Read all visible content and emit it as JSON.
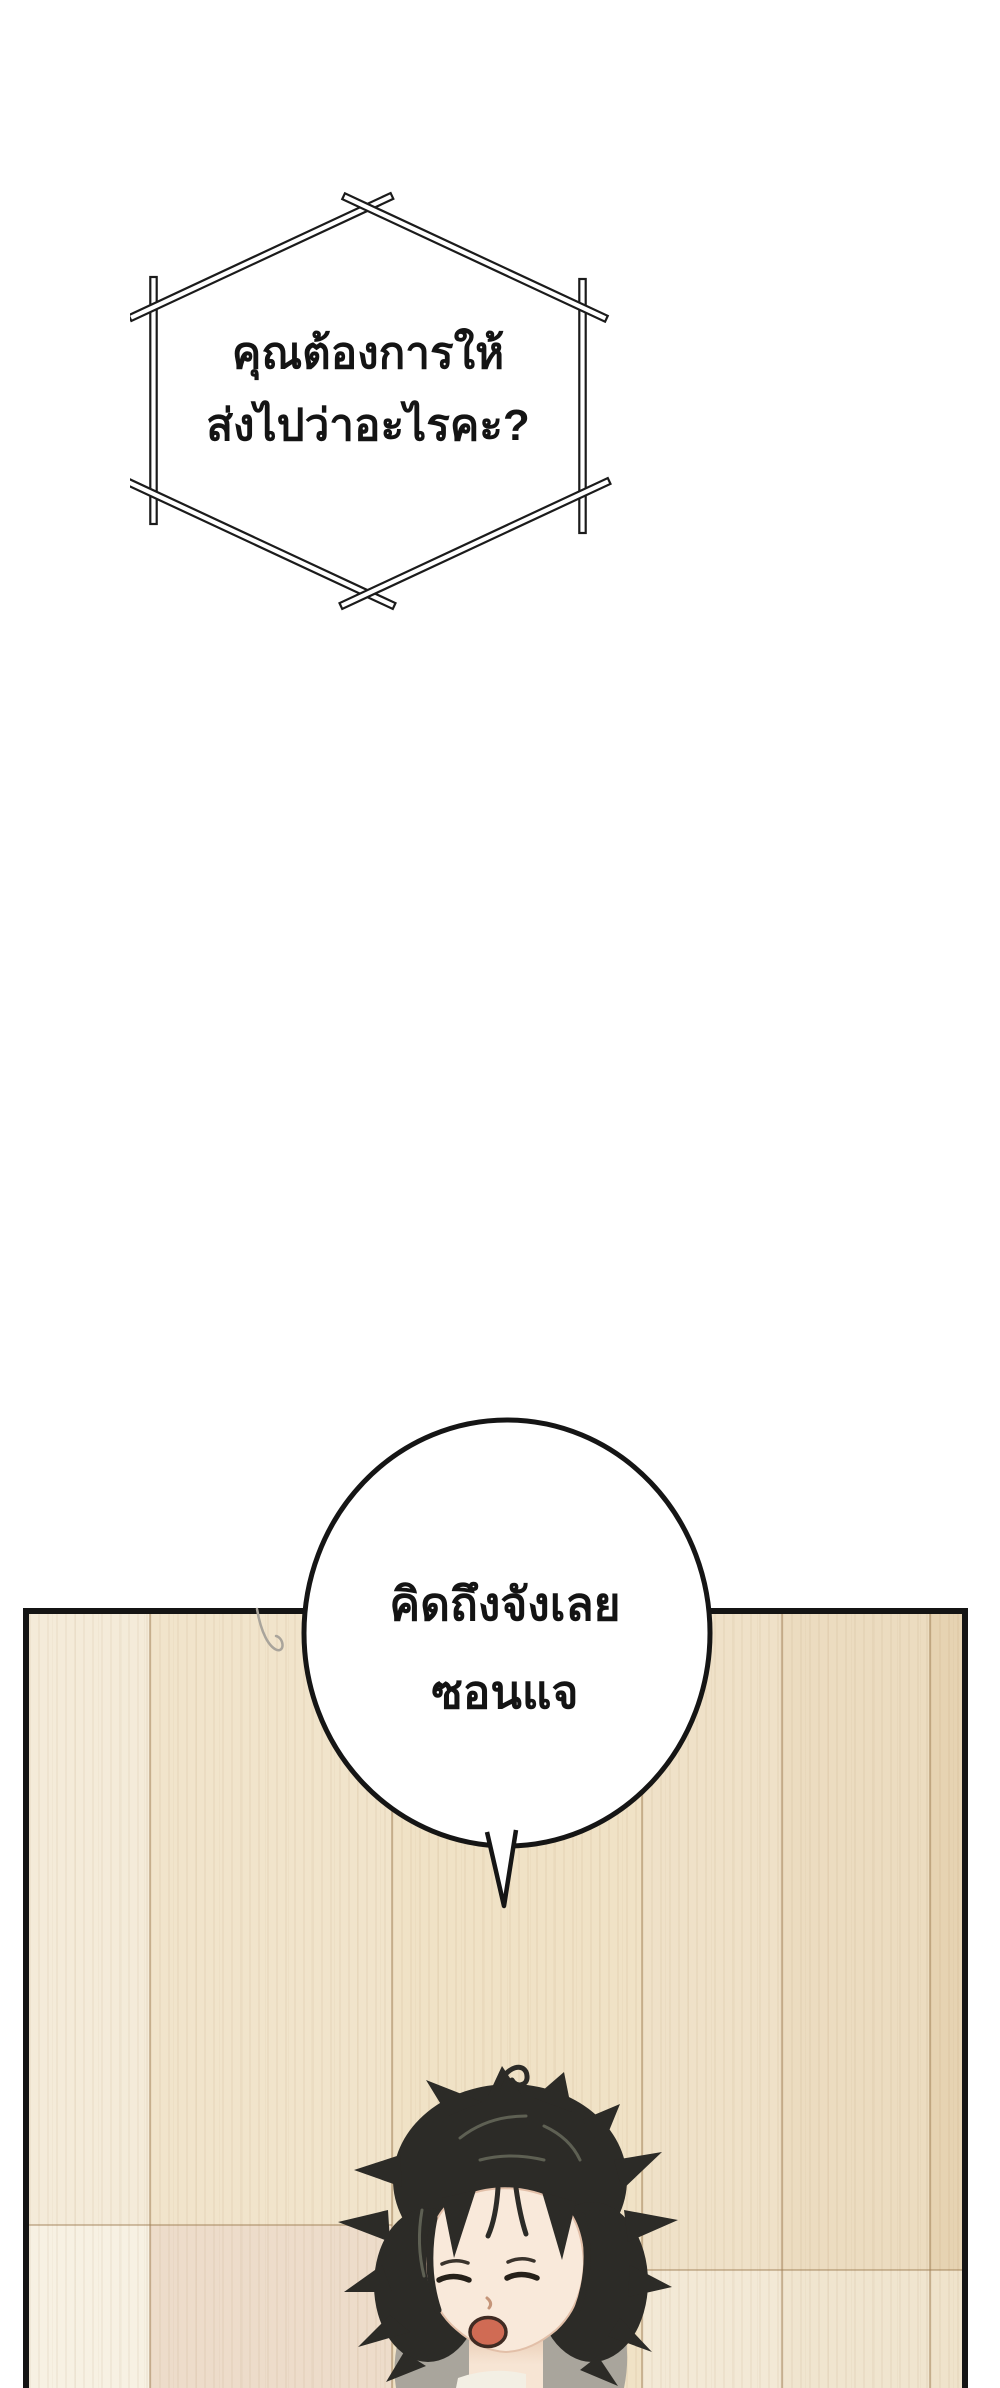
{
  "comic": {
    "bubbles": {
      "hexagon": {
        "shape": "hexagon-of-crossed-sticks",
        "line1": "คุณต้องการให้",
        "line2": "ส่งไปว่าอะไรคะ?"
      },
      "round": {
        "shape": "ellipse-with-tail",
        "line1": "คิดถึงจังเลย",
        "line2": "ซอนแจ"
      }
    },
    "panel": {
      "description": "wooden floor panel with yawning character head",
      "border_color": "#141414"
    },
    "colors": {
      "ink": "#1a1a1a",
      "bubble_fill": "#ffffff",
      "wood_base": "#f0e3c9",
      "wood_light": "#f6f0e2",
      "wood_dark": "#e6d3b2",
      "hair": "#2c2b27",
      "skin": "#f8e8da",
      "mouth": "#d06b54",
      "floor_shadow_gray": "#a9a59c"
    }
  }
}
